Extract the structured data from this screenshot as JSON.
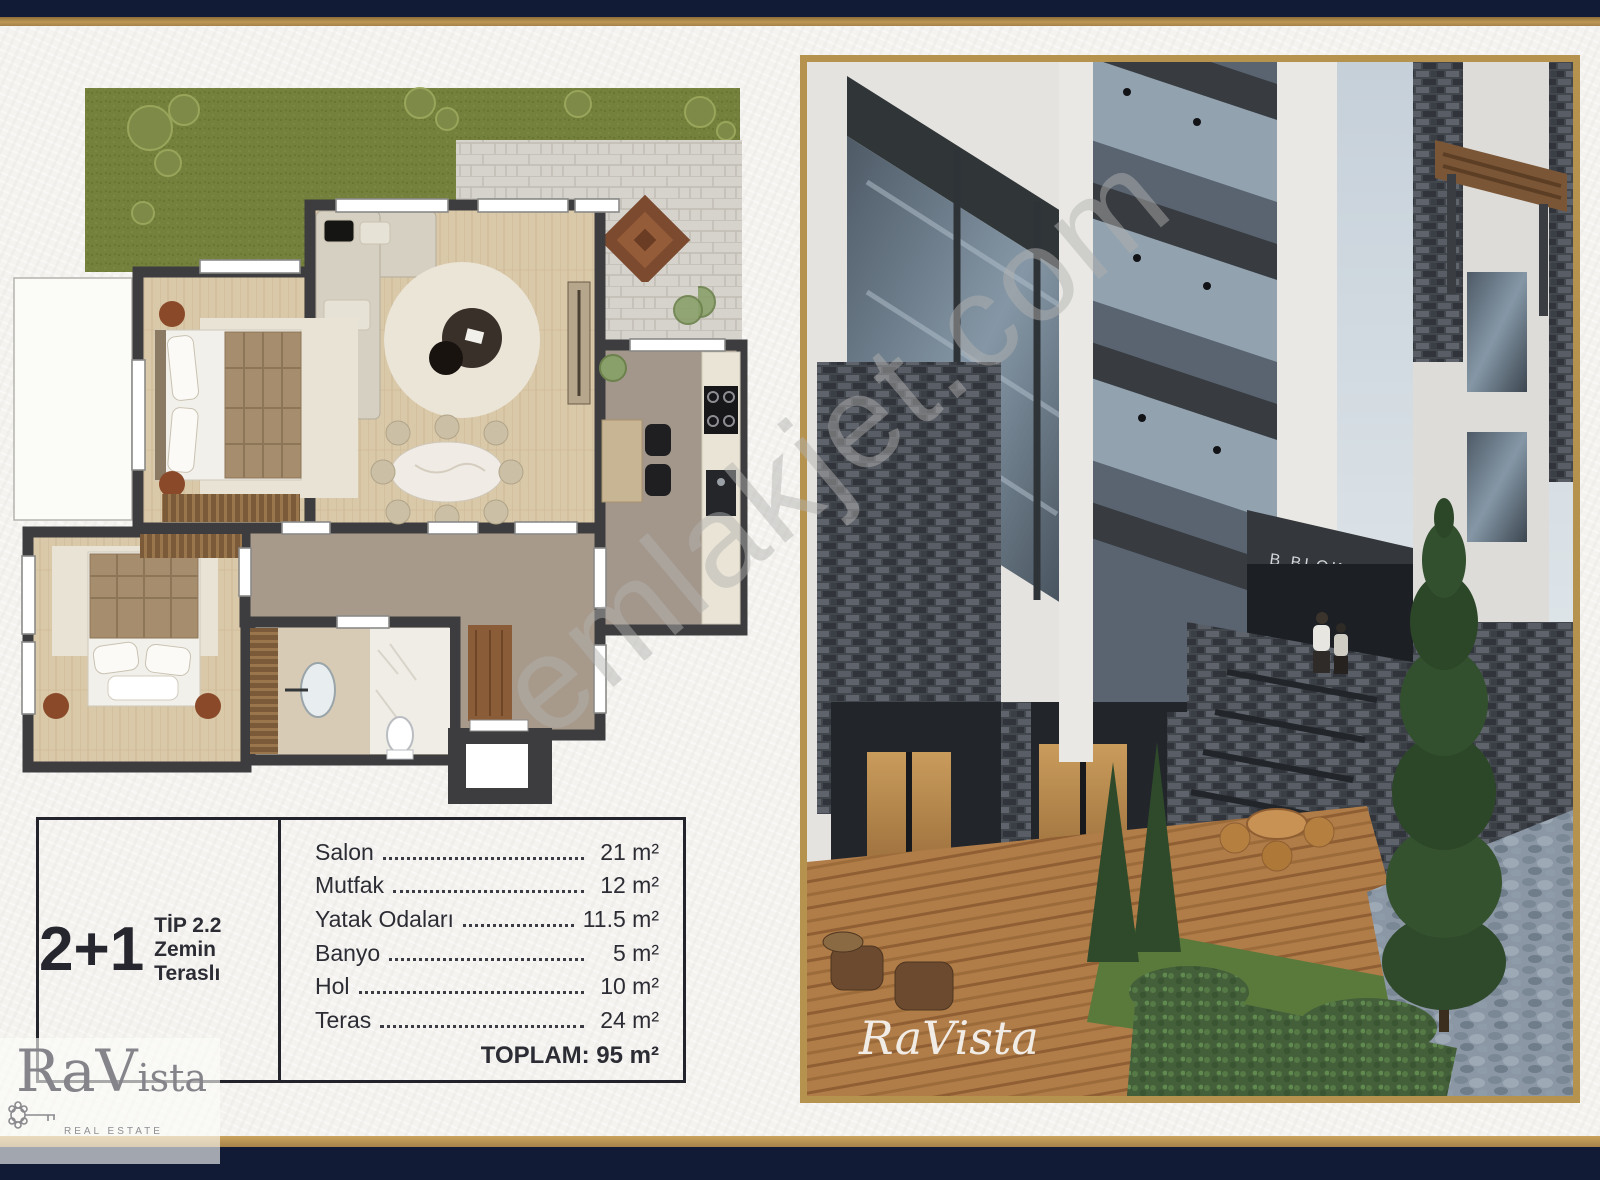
{
  "colors": {
    "frame_navy": "#111b36",
    "frame_gold": "#b6924f",
    "paper": "#f4f3f0",
    "plan_wall": "#3d3d3f",
    "grass_green": "#74813c",
    "wood_floor": "#dac9a9",
    "hall_floor": "#a89a8b"
  },
  "watermark": {
    "text": "emlakjet.com"
  },
  "spec_table": {
    "unit_type": "2+1",
    "type_label": "TİP 2.2",
    "type_sublabel": "Zemin Teraslı",
    "rows": [
      {
        "label": "Salon",
        "value": "21 m²"
      },
      {
        "label": "Mutfak",
        "value": "12 m²"
      },
      {
        "label": "Yatak Odaları",
        "value": "11.5 m²"
      },
      {
        "label": "Banyo",
        "value": "5 m²"
      },
      {
        "label": "Hol",
        "value": "10 m²"
      },
      {
        "label": "Teras",
        "value": "24 m²"
      }
    ],
    "total": "TOPLAM: 95 m²"
  },
  "brand": {
    "name_part1": "Ra",
    "name_part2": "Vista",
    "tagline": "REAL ESTATE"
  },
  "photo": {
    "sign": "B BLOK",
    "script_watermark": "RaVista"
  }
}
